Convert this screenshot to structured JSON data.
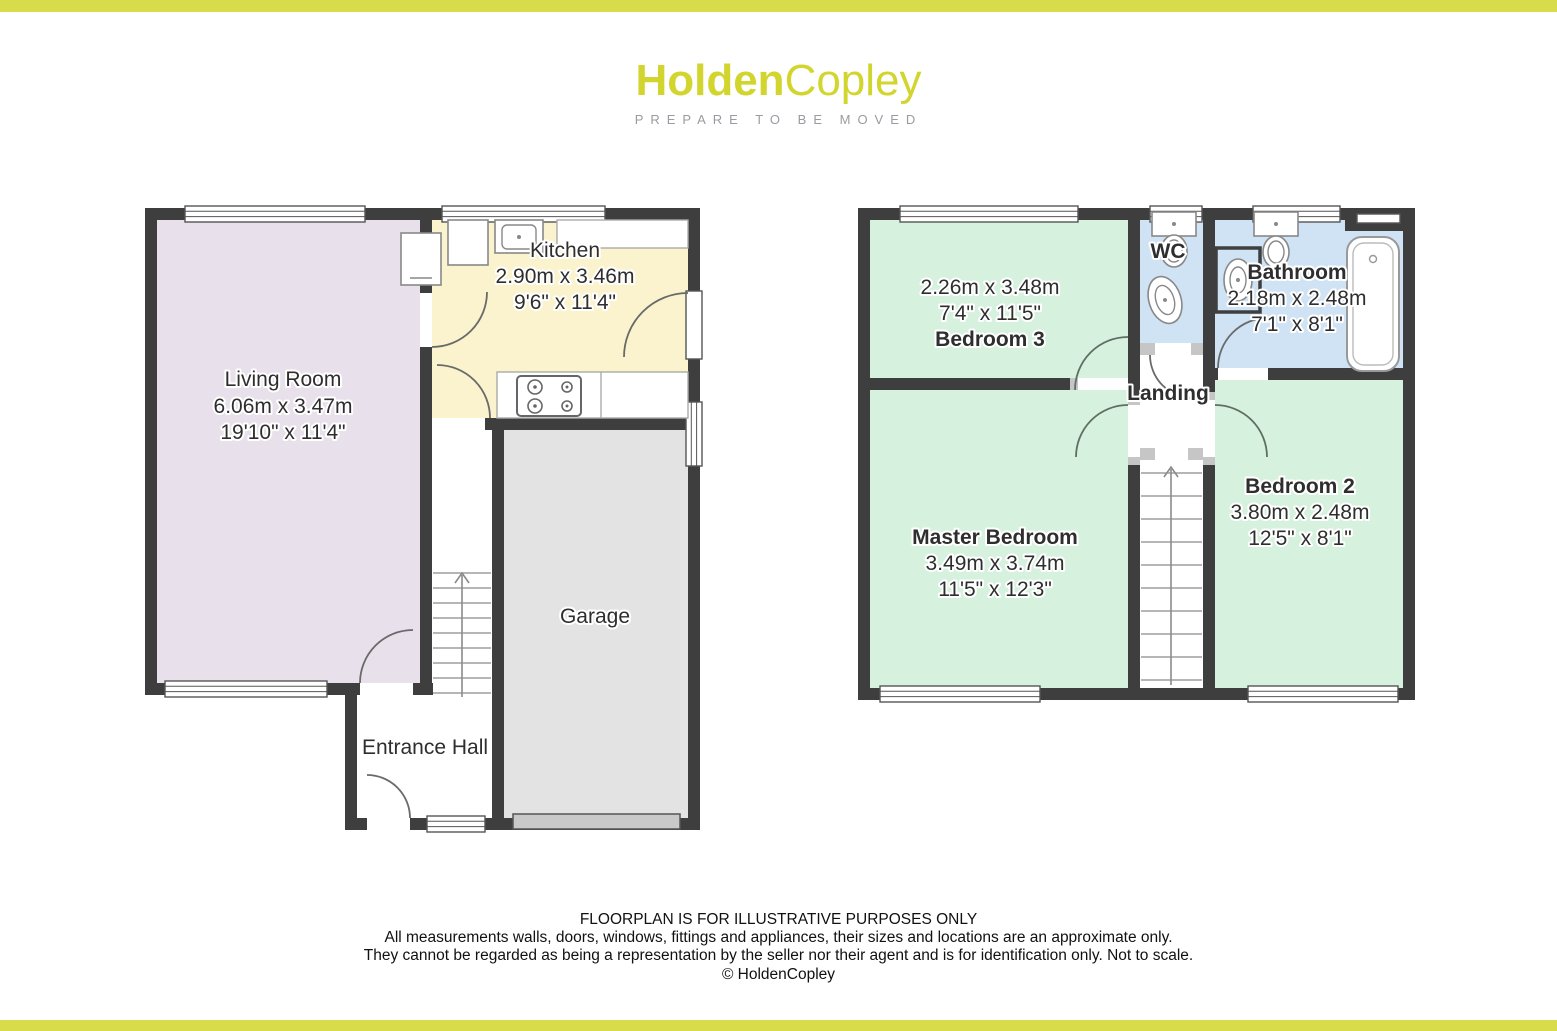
{
  "brand": {
    "logo_bold": "Holden",
    "logo_light": "Copley",
    "tagline": "PREPARE TO BE MOVED"
  },
  "colors": {
    "brand_yellow": "#d2d52e",
    "bar_yellow": "#d8dc4b",
    "wall": "#3e3e3e",
    "living_room": "#e8e0ea",
    "kitchen": "#faf3cd",
    "garage": "#e3e3e3",
    "bedroom": "#d7f1df",
    "bathroom": "#cfe3f5",
    "hall": "#ffffff"
  },
  "floors": {
    "ground": {
      "living_room": {
        "name": "Living Room",
        "metric": "6.06m x 3.47m",
        "imperial": "19'10\" x 11'4\""
      },
      "kitchen": {
        "name": "Kitchen",
        "metric": "2.90m x 3.46m",
        "imperial": "9'6\" x 11'4\""
      },
      "garage": {
        "name": "Garage"
      },
      "entrance_hall": {
        "name": "Entrance Hall"
      }
    },
    "first": {
      "bedroom3": {
        "metric": "2.26m x 3.48m",
        "imperial": "7'4\" x 11'5\"",
        "name": "Bedroom 3"
      },
      "wc": {
        "name": "WC"
      },
      "bathroom": {
        "name": "Bathroom",
        "metric": "2.18m x 2.48m",
        "imperial": "7'1\" x 8'1\""
      },
      "landing": {
        "name": "Landing"
      },
      "master_bedroom": {
        "name": "Master Bedroom",
        "metric": "3.49m x 3.74m",
        "imperial": "11'5\" x 12'3\""
      },
      "bedroom2": {
        "name": "Bedroom 2",
        "metric": "3.80m x 2.48m",
        "imperial": "12'5\" x 8'1\""
      }
    }
  },
  "disclaimer": {
    "line1": "FLOORPLAN IS FOR ILLUSTRATIVE PURPOSES ONLY",
    "line2": "All measurements walls, doors, windows, fittings and appliances, their sizes and locations are an approximate only.",
    "line3": "They cannot be regarded as being a representation by the seller nor their agent and is for identification only. Not to scale.",
    "copyright": "© HoldenCopley"
  }
}
